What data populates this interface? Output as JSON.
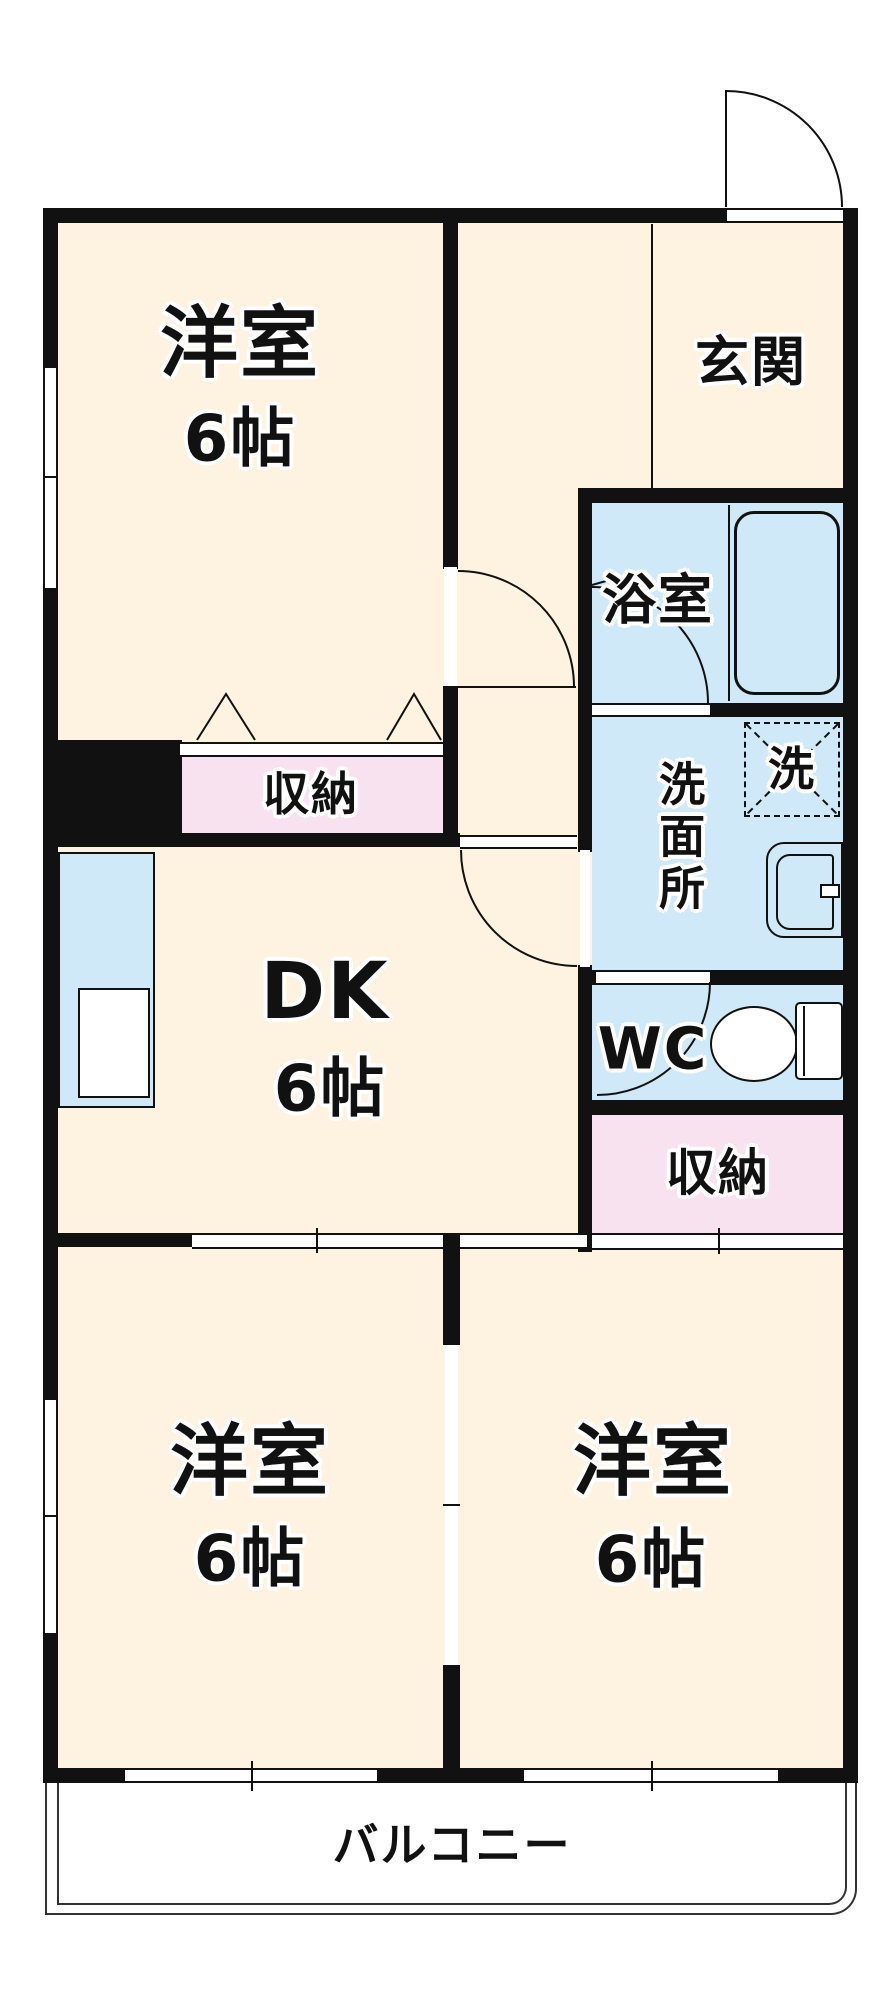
{
  "floorplan": {
    "rooms": {
      "bedroom_top_left": {
        "name": "洋室",
        "size": "6帖"
      },
      "dining_kitchen": {
        "name": "DK",
        "size": "6帖"
      },
      "bedroom_bottom_left": {
        "name": "洋室",
        "size": "6帖"
      },
      "bedroom_bottom_right": {
        "name": "洋室",
        "size": "6帖"
      },
      "entrance": {
        "name": "玄関"
      },
      "bathroom": {
        "name": "浴室"
      },
      "washroom": {
        "name": "洗面所"
      },
      "toilet": {
        "name": "WC"
      },
      "closet_left": {
        "name": "収納"
      },
      "closet_right": {
        "name": "収納"
      },
      "balcony": {
        "name": "バルコニー"
      }
    },
    "fixtures": {
      "washing_machine_label": "洗",
      "bathtub": "bathtub",
      "wash_basin": "wash-basin",
      "toilet_bowl": "toilet",
      "kitchen_counter": "kitchen-sink-counter"
    },
    "colors": {
      "wall": "#111111",
      "room_floor": "#fdf3e0",
      "wet_area": "#cfe9f8",
      "closet": "#f9e2ef",
      "background": "#ffffff"
    }
  }
}
